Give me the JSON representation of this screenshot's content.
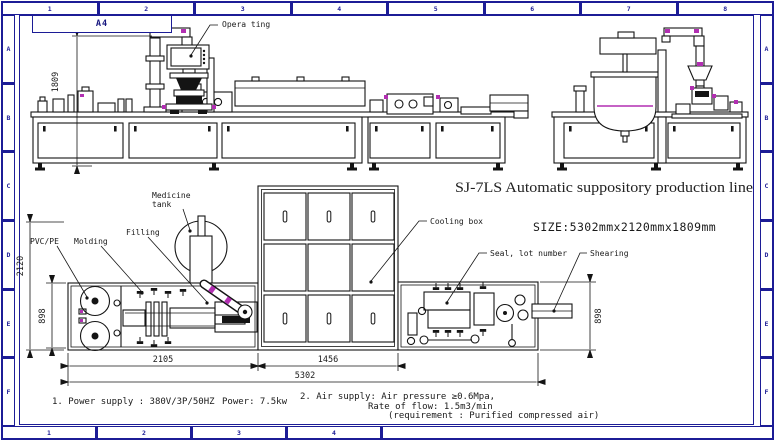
{
  "sheet": {
    "format": "A4",
    "top_zone_numbers": [
      "1",
      "2",
      "3",
      "4",
      "5",
      "6",
      "7",
      "8"
    ],
    "bottom_zone_numbers": [
      "1",
      "2",
      "3",
      "4"
    ],
    "left_zone_letters": [
      "A",
      "B",
      "C",
      "D",
      "E",
      "F"
    ],
    "right_zone_letters": [
      "A",
      "B",
      "C",
      "D",
      "E",
      "F"
    ]
  },
  "title_block": {
    "product_title": "SJ-7LS Automatic suppository production line",
    "size_note": "SIZE:5302mmx2120mmx1809mm"
  },
  "callouts": {
    "operating": "Opera ting",
    "medicine_tank_line1": "Medicine",
    "medicine_tank_line2": "tank",
    "filling": "Filling",
    "pvc_pe": "PVC/PE",
    "molding": "Molding",
    "cooling_box": "Cooling box",
    "seal_lot_number": "Seal, lot number",
    "shearing": "Shearing"
  },
  "dimensions": {
    "front_height": "1809",
    "plan_total_depth": "2120",
    "plan_left_depth": "898",
    "plan_right_depth": "898",
    "molding_length": "2105",
    "cooling_length": "1456",
    "total_length": "5302"
  },
  "notes": {
    "power_line": "1. Power supply : 380V/3P/50HZ",
    "power_rating": "Power: 7.5kw",
    "air_line1": "2. Air supply:  Air pressure ≥0.6Mpa,",
    "air_line2": "Rate of flow: 1.5m3/min",
    "air_line3": "(requirement : Purified compressed air)"
  },
  "colors": {
    "frame_navy": "#1c1c96",
    "line_black": "#141414",
    "accent_magenta": "#b22fb2"
  }
}
